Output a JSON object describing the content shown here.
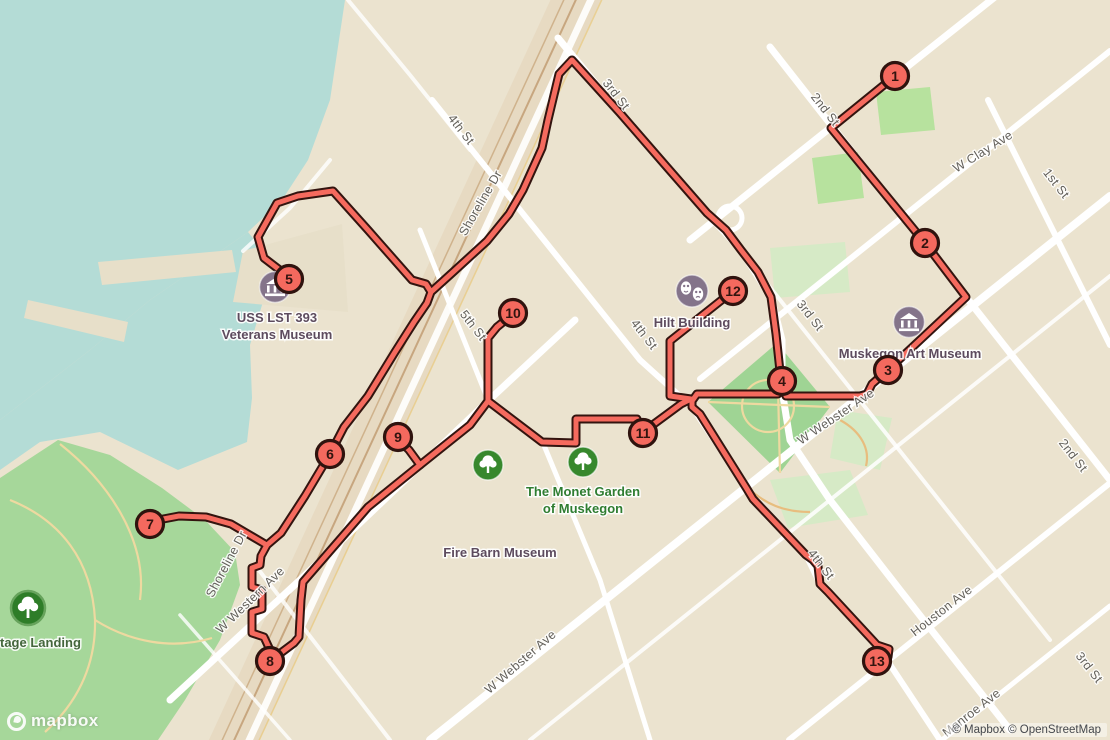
{
  "map": {
    "attribution": "© Mapbox © OpenStreetMap",
    "logo_word": "mapbox",
    "colors": {
      "land": "#ebe3cf",
      "water": "#b4dcd6",
      "park": "#a6d79a",
      "park_pale": "#d6eac6",
      "road": "#ffffff",
      "route": "#f56a5e",
      "route_casing": "#33140f",
      "marker_fill": "#f4695e",
      "marker_stroke": "#2f130e",
      "corridor": "#e7dac2",
      "street_label": "#63605a",
      "museum_icon": "#84748a",
      "tree_icon": "#37882d"
    },
    "markers": [
      {
        "n": "1",
        "x": 895,
        "y": 76
      },
      {
        "n": "2",
        "x": 925,
        "y": 243
      },
      {
        "n": "3",
        "x": 888,
        "y": 370
      },
      {
        "n": "4",
        "x": 782,
        "y": 381
      },
      {
        "n": "5",
        "x": 289,
        "y": 279
      },
      {
        "n": "6",
        "x": 330,
        "y": 454
      },
      {
        "n": "7",
        "x": 150,
        "y": 524
      },
      {
        "n": "8",
        "x": 270,
        "y": 661
      },
      {
        "n": "9",
        "x": 398,
        "y": 437
      },
      {
        "n": "10",
        "x": 513,
        "y": 313
      },
      {
        "n": "11",
        "x": 643,
        "y": 433
      },
      {
        "n": "12",
        "x": 733,
        "y": 291
      },
      {
        "n": "13",
        "x": 877,
        "y": 661
      }
    ],
    "street_labels": [
      {
        "text": "3rd St",
        "x": 613,
        "y": 97,
        "a": 52
      },
      {
        "text": "2nd St",
        "x": 822,
        "y": 112,
        "a": 52
      },
      {
        "text": "4th St",
        "x": 458,
        "y": 132,
        "a": 52
      },
      {
        "text": "Shoreline Dr",
        "x": 484,
        "y": 205,
        "a": -60
      },
      {
        "text": "W Clay Ave",
        "x": 985,
        "y": 155,
        "a": -32
      },
      {
        "text": "1st St",
        "x": 1053,
        "y": 186,
        "a": 52
      },
      {
        "text": "5th St",
        "x": 470,
        "y": 328,
        "a": 52
      },
      {
        "text": "4th St",
        "x": 641,
        "y": 337,
        "a": 52
      },
      {
        "text": "3rd St",
        "x": 807,
        "y": 318,
        "a": 52
      },
      {
        "text": "W Webster Ave",
        "x": 838,
        "y": 420,
        "a": -34
      },
      {
        "text": "2nd St",
        "x": 1070,
        "y": 458,
        "a": 52
      },
      {
        "text": "Shoreline Dr",
        "x": 230,
        "y": 566,
        "a": -62
      },
      {
        "text": "W Western Ave",
        "x": 253,
        "y": 603,
        "a": -44
      },
      {
        "text": "Houston Ave",
        "x": 944,
        "y": 614,
        "a": -38
      },
      {
        "text": "Monroe Ave",
        "x": 974,
        "y": 716,
        "a": -38
      },
      {
        "text": "3rd St",
        "x": 1086,
        "y": 670,
        "a": 52
      },
      {
        "text": "4th St",
        "x": 818,
        "y": 567,
        "a": 52
      },
      {
        "text": "W Webster Ave",
        "x": 523,
        "y": 665,
        "a": -41
      }
    ],
    "pois": [
      {
        "cls": "poi-museum",
        "x": 277,
        "y": 322,
        "anchor": "middle",
        "lines": [
          "USS LST 393",
          "Veterans Museum"
        ]
      },
      {
        "cls": "poi-museum",
        "x": 910,
        "y": 358,
        "anchor": "middle",
        "lines": [
          "Muskegon Art Museum"
        ]
      },
      {
        "cls": "poi-museum",
        "x": 692,
        "y": 327,
        "anchor": "middle",
        "lines": [
          "Hilt Building"
        ]
      },
      {
        "cls": "poi-green",
        "x": 583,
        "y": 496,
        "anchor": "middle",
        "lines": [
          "The Monet Garden",
          "of Muskegon"
        ]
      },
      {
        "cls": "poi-museum",
        "x": 500,
        "y": 557,
        "anchor": "middle",
        "lines": [
          "Fire Barn Museum"
        ]
      },
      {
        "cls": "poi-park",
        "x": 0,
        "y": 647,
        "anchor": "start",
        "lines": [
          "tage Landing"
        ]
      }
    ]
  }
}
